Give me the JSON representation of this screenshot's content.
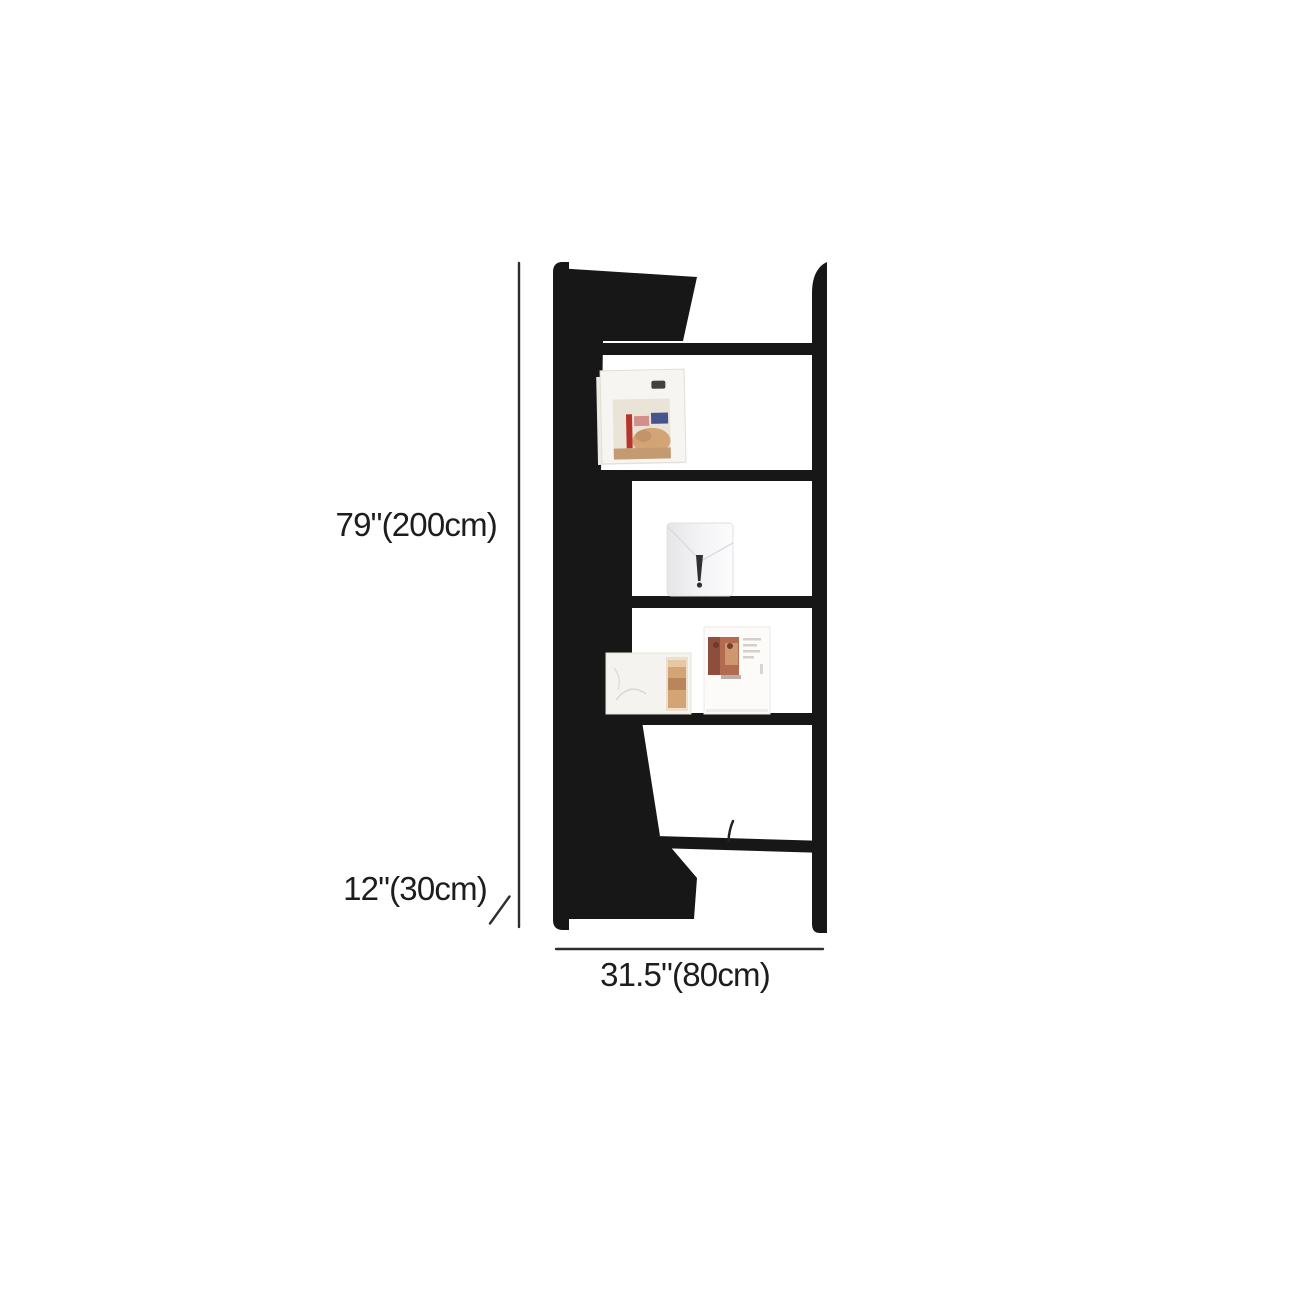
{
  "page": {
    "background_color": "#ffffff",
    "description_labels": {
      "height_label": "79\"(200cm)",
      "depth_label": "12\"(30cm)",
      "width_label": "31.5\"(80cm)"
    }
  },
  "product_diagram": {
    "kind": "bookshelf-dimension-diagram",
    "shelf_count": 5,
    "items_on_shelves": [
      "magazine-with-figure-cover",
      "white-card-with-vase-print",
      "sketch-card-with-art-strip",
      "magazine-with-photo-and-text",
      "small-pen-mark"
    ],
    "colors": {
      "shelf_black": "#171717",
      "dimension_line": "#2e2e2e",
      "label_text": "#1d1d1d",
      "magazine_red": "#b5342c",
      "magazine_blue": "#46538c",
      "magazine_tan": "#d2a476",
      "photo_rust": "#b26a50",
      "card_white": "#f6f4f1"
    }
  }
}
